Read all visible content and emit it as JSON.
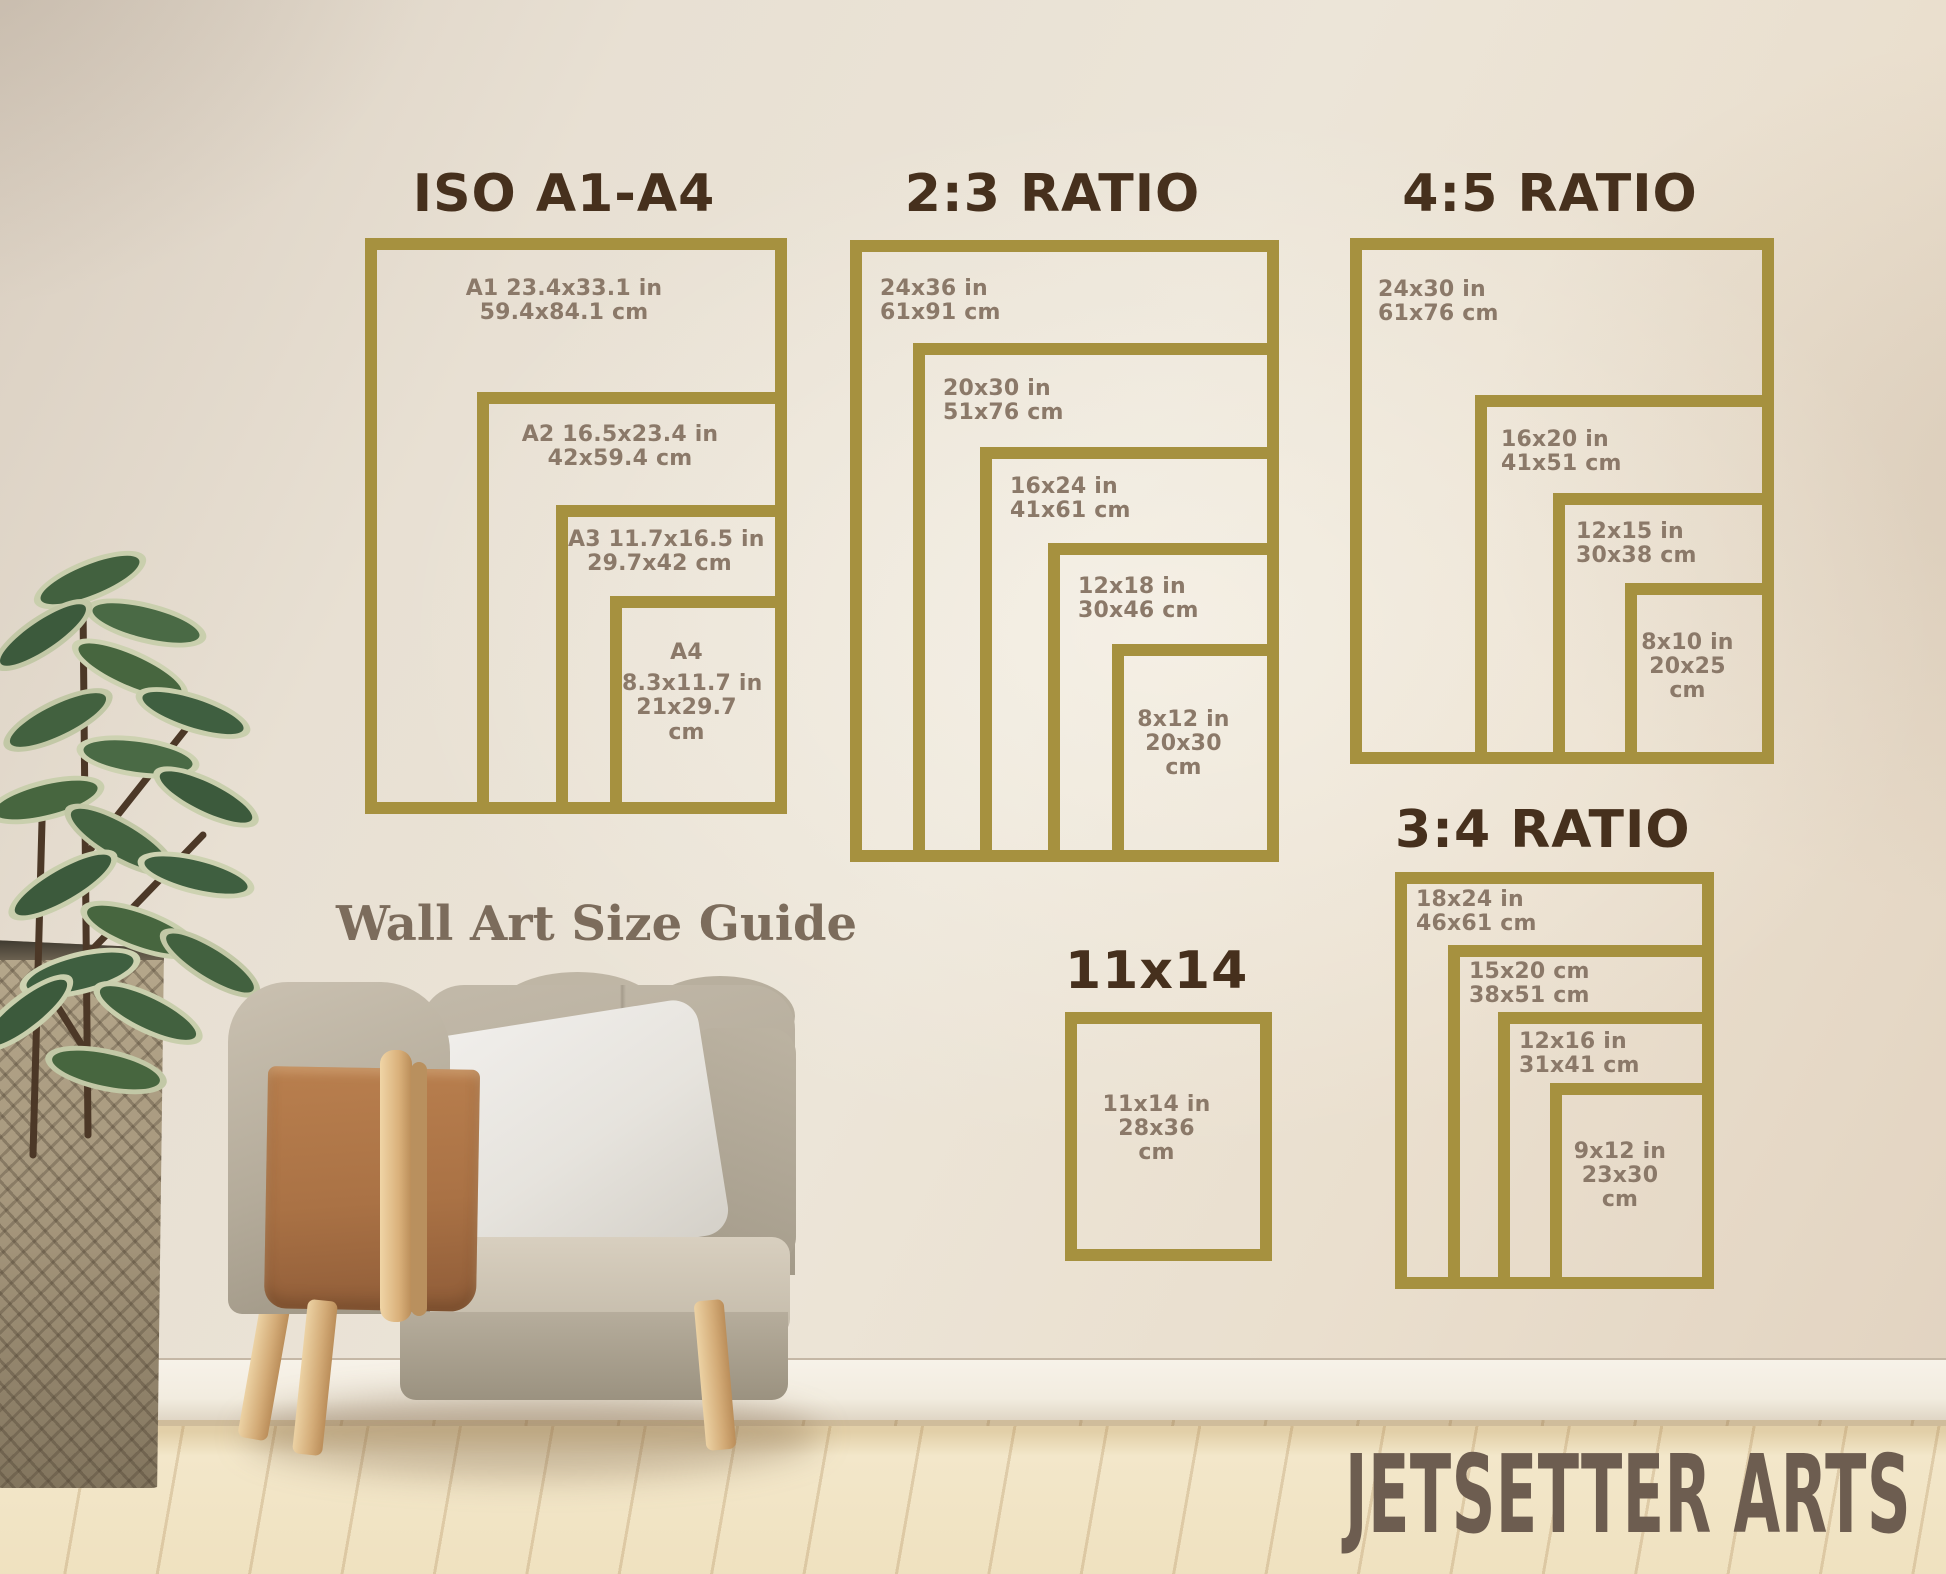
{
  "brand": "JETSETTER ARTS",
  "guide_title": "Wall Art Size Guide",
  "colors": {
    "frame_gold": "#a6913f",
    "section_title_brown": "#46301d",
    "size_label_brown": "#8b7969",
    "guide_title_color": "#7c6c5c",
    "brand_color": "#6d5d50"
  },
  "sections": {
    "iso": {
      "title": "ISO A1-A4",
      "items": [
        {
          "name": "A1",
          "lines": [
            "A1 23.4x33.1 in",
            "59.4x84.1 cm"
          ]
        },
        {
          "name": "A2",
          "lines": [
            "A2 16.5x23.4 in",
            "42x59.4 cm"
          ]
        },
        {
          "name": "A3",
          "lines": [
            "A3 11.7x16.5 in",
            "29.7x42 cm"
          ]
        },
        {
          "name": "A4",
          "lines": [
            "A4",
            "8.3x11.7 in",
            "21x29.7",
            "cm"
          ]
        }
      ]
    },
    "ratio23": {
      "title": "2:3 RATIO",
      "items": [
        {
          "name": "24x36",
          "lines": [
            "24x36 in",
            "61x91 cm"
          ]
        },
        {
          "name": "20x30",
          "lines": [
            "20x30 in",
            "51x76 cm"
          ]
        },
        {
          "name": "16x24",
          "lines": [
            "16x24 in",
            "41x61 cm"
          ]
        },
        {
          "name": "12x18",
          "lines": [
            "12x18 in",
            "30x46 cm"
          ]
        },
        {
          "name": "8x12",
          "lines": [
            "8x12 in",
            "20x30",
            "cm"
          ]
        }
      ]
    },
    "ratio45": {
      "title": "4:5 RATIO",
      "items": [
        {
          "name": "24x30",
          "lines": [
            "24x30 in",
            "61x76 cm"
          ]
        },
        {
          "name": "16x20",
          "lines": [
            "16x20 in",
            "41x51 cm"
          ]
        },
        {
          "name": "12x15",
          "lines": [
            "12x15 in",
            "30x38 cm"
          ]
        },
        {
          "name": "8x10",
          "lines": [
            "8x10 in",
            "20x25",
            "cm"
          ]
        }
      ]
    },
    "ratio34": {
      "title": "3:4 RATIO",
      "items": [
        {
          "name": "18x24",
          "lines": [
            "18x24 in",
            "46x61 cm"
          ]
        },
        {
          "name": "15x20",
          "lines": [
            "15x20 cm",
            "38x51 cm"
          ]
        },
        {
          "name": "12x16",
          "lines": [
            "12x16 in",
            "31x41 cm"
          ]
        },
        {
          "name": "9x12",
          "lines": [
            "9x12 in",
            "23x30",
            "cm"
          ]
        }
      ]
    },
    "s11x14": {
      "title": "11x14",
      "items": [
        {
          "name": "11x14",
          "lines": [
            "11x14 in",
            "28x36",
            "cm"
          ]
        }
      ]
    }
  }
}
